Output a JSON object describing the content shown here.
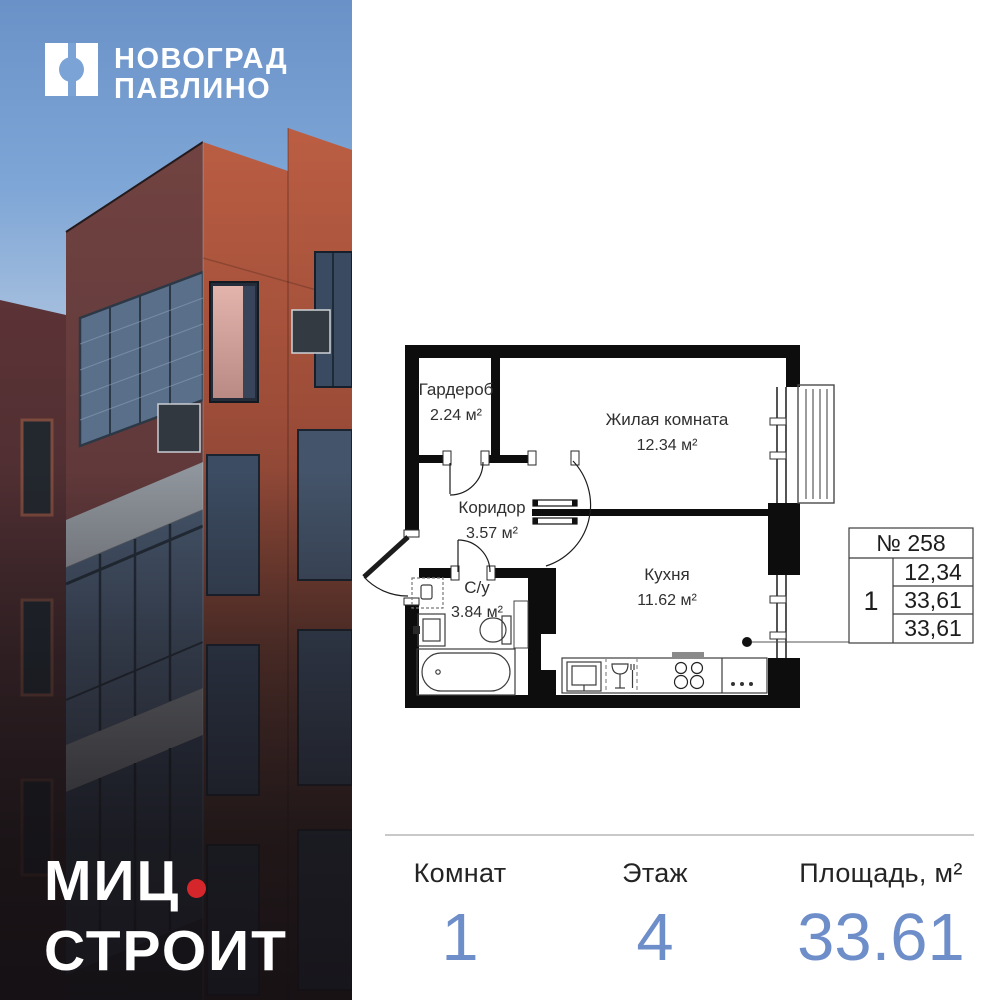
{
  "brand": {
    "project_name_line1": "НОВОГРАД",
    "project_name_line2": "ПАВЛИНО",
    "developer_name": "МИЦ",
    "developer_suffix": "СТРОИТ"
  },
  "floor_plan": {
    "rooms": [
      {
        "name": "Гардероб",
        "area": "2.24 м²"
      },
      {
        "name": "Жилая комната",
        "area": "12.34 м²"
      },
      {
        "name": "Коридор",
        "area": "3.57 м²"
      },
      {
        "name": "С/у",
        "area": "3.84 м²"
      },
      {
        "name": "Кухня",
        "area": "11.62 м²"
      }
    ],
    "info_table": {
      "apartment_number": "№ 258",
      "rooms_count": "1",
      "row1": "12,34",
      "row2": "33,61",
      "row3": "33,61"
    }
  },
  "stats": {
    "columns": [
      {
        "label": "Комнат",
        "value": "1"
      },
      {
        "label": "Этаж",
        "value": "4"
      },
      {
        "label": "Площадь, м²",
        "value": "33.61"
      }
    ]
  },
  "colors": {
    "accent_blue": "#6e8ec9",
    "brand_red": "#d5272b",
    "sky_blue": "#7ba3d6"
  }
}
